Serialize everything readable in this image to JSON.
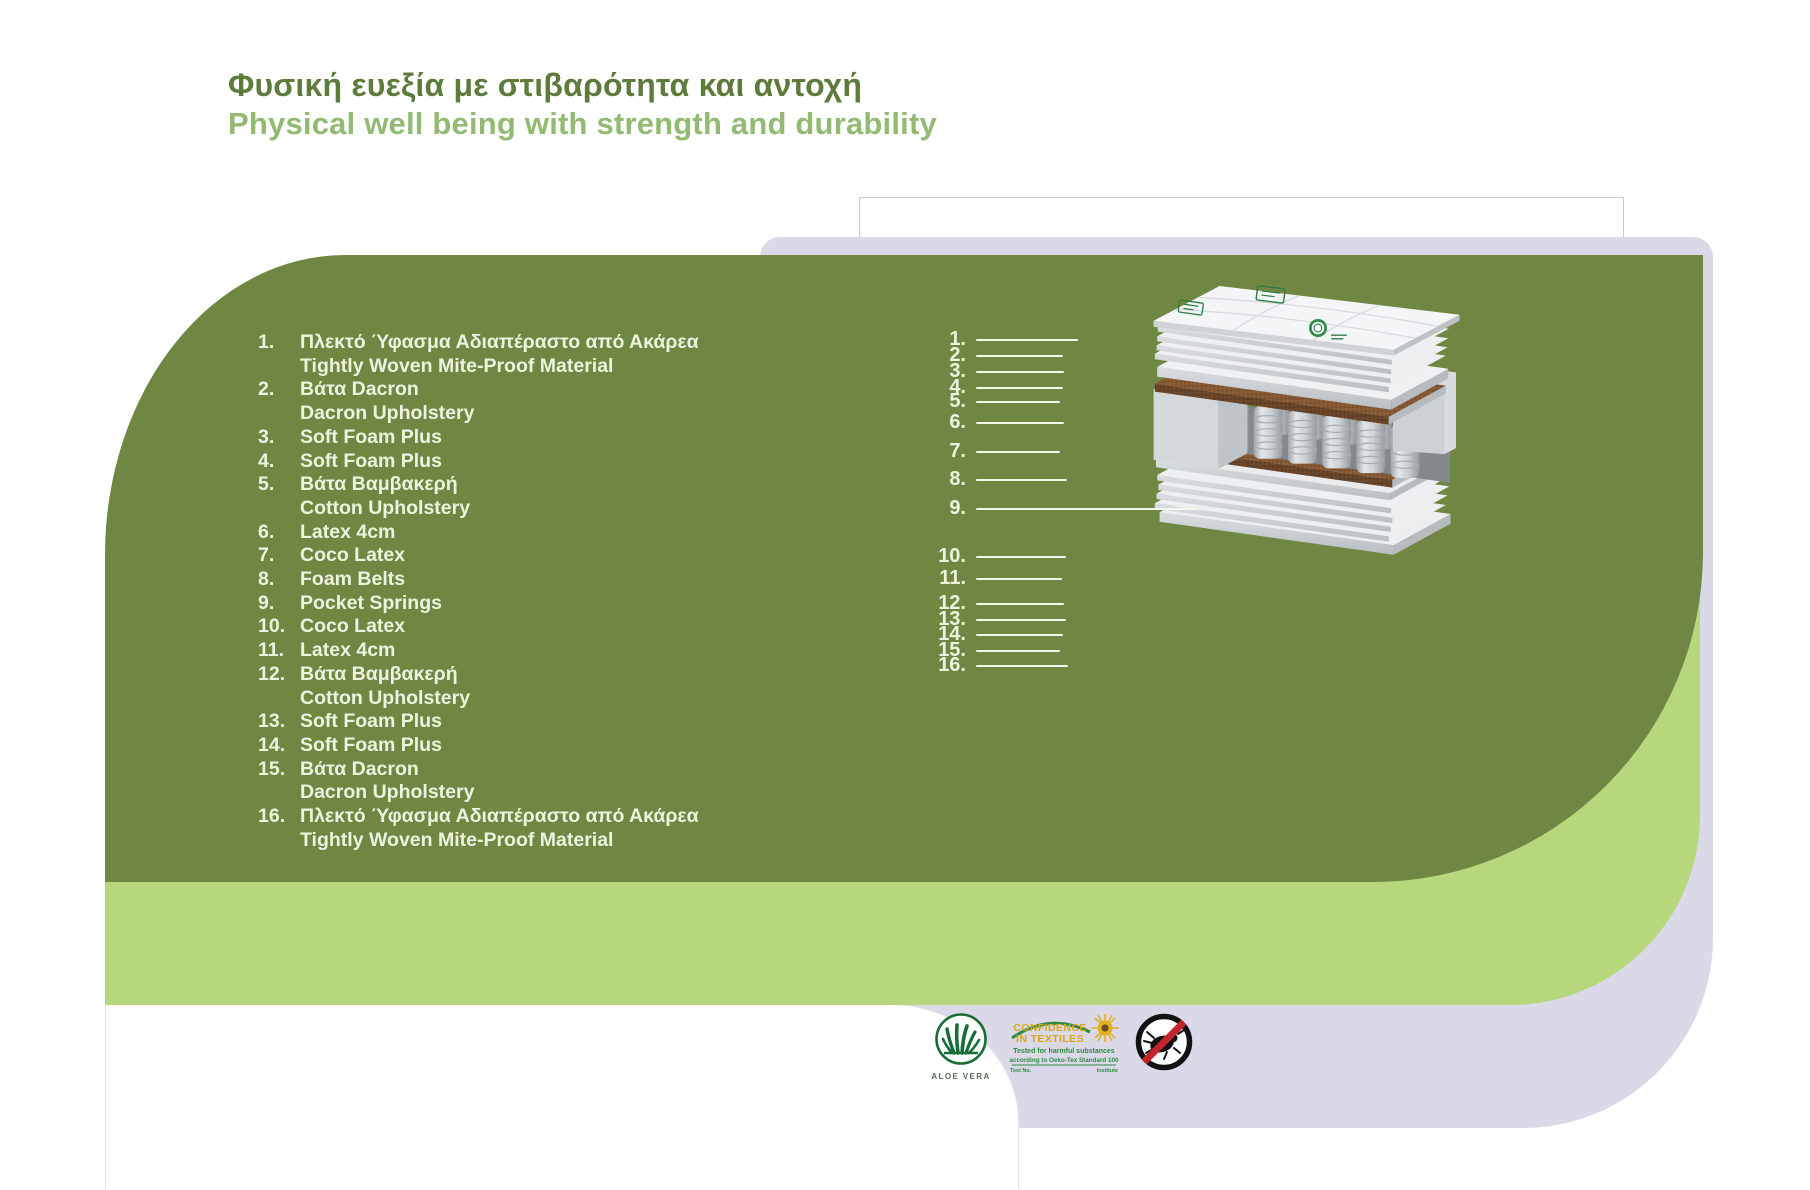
{
  "title": {
    "greek": "Φυσική ευεξία με στιβαρότητα και αντοχή",
    "english": "Physical well being with strength and durability"
  },
  "layers": [
    {
      "label": "1.",
      "lines": [
        "Πλεκτό Ύφασμα Αδιαπέραστο από Ακάρεα",
        "Tightly Woven Mite-Proof Material"
      ]
    },
    {
      "label": "2.",
      "lines": [
        "Βάτα Dacron",
        "Dacron Upholstery"
      ]
    },
    {
      "label": "3.",
      "lines": [
        "Soft Foam Plus"
      ]
    },
    {
      "label": "4.",
      "lines": [
        "Soft Foam Plus"
      ]
    },
    {
      "label": "5.",
      "lines": [
        "Βάτα Βαμβακερή",
        "Cotton Upholstery"
      ]
    },
    {
      "label": "6.",
      "lines": [
        "Latex 4cm"
      ]
    },
    {
      "label": "7.",
      "lines": [
        "Coco Latex"
      ]
    },
    {
      "label": "8.",
      "lines": [
        "Foam Belts"
      ]
    },
    {
      "label": "9.",
      "lines": [
        "Pocket Springs"
      ]
    },
    {
      "label": "10.",
      "lines": [
        "Coco Latex"
      ]
    },
    {
      "label": "11.",
      "lines": [
        "Latex 4cm"
      ]
    },
    {
      "label": "12.",
      "lines": [
        "Βάτα Βαμβακερή",
        "Cotton Upholstery"
      ]
    },
    {
      "label": "13.",
      "lines": [
        "Soft Foam Plus"
      ]
    },
    {
      "label": "14.",
      "lines": [
        "Soft Foam Plus"
      ]
    },
    {
      "label": "15.",
      "lines": [
        "Βάτα Dacron",
        "Dacron Upholstery"
      ]
    },
    {
      "label": "16.",
      "lines": [
        "Πλεκτό Ύφασμα Αδιαπέραστο από Ακάρεα",
        "Tightly Woven Mite-Proof Material"
      ]
    }
  ],
  "badges": {
    "aloe_vera": {
      "label": "ALOE VERA"
    },
    "oeko_tex": {
      "title_line1": "CONFIDENCE",
      "title_line2": "IN TEXTILES",
      "tested": "Tested for harmful substances",
      "standard": "according to Oeko-Tex Standard 100",
      "footnote_left": "Test No.",
      "footnote_right": "Institute"
    }
  },
  "colors": {
    "olive": "#6f8742",
    "lime": "#b6d77c",
    "lavender": "#dbd8e7",
    "title_greek": "#5d7b3b",
    "title_english": "#92ba72",
    "list_text": "#ecf4de",
    "callout_line": "#f2f8e8"
  }
}
